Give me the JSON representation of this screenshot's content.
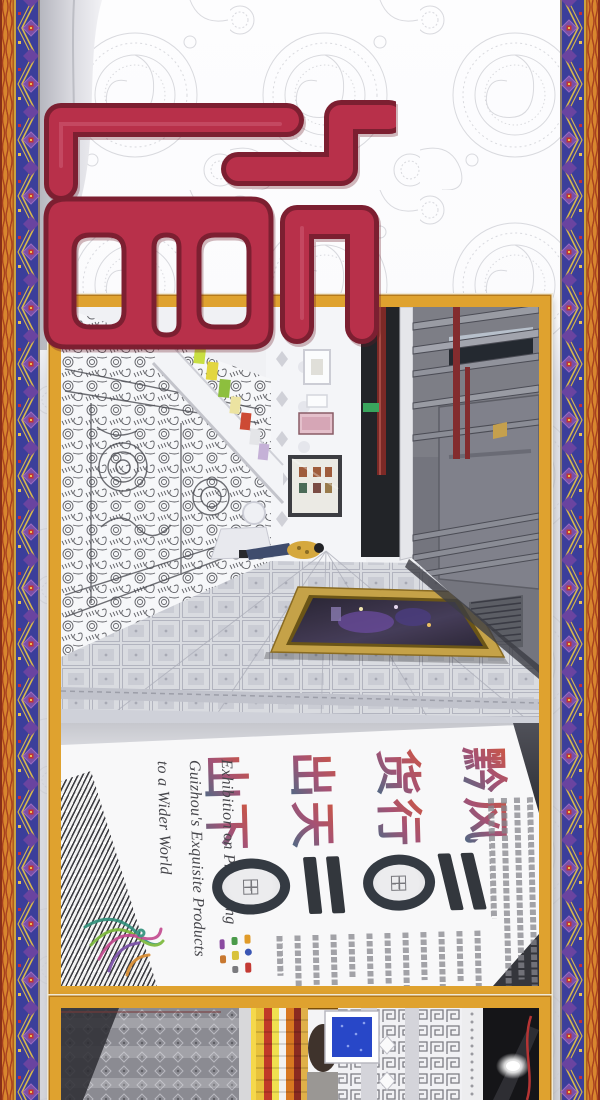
{
  "page": {
    "kind": "exhibition promotional poster page",
    "note": "photos and slogan displayed rotated 90 degrees"
  },
  "poster": {
    "slogan_reading": "黔货出山 风行天下",
    "slogan_columns": [
      {
        "chars": [
          "黔",
          "货",
          "出",
          "山"
        ]
      },
      {
        "chars": [
          "风",
          "行",
          "天",
          "下"
        ]
      }
    ],
    "english_lines": [
      "Exhibition on Promoting",
      "Guizhou's Exquisite Products",
      "to a Wider World"
    ]
  },
  "colors": {
    "frame_gold": "#dfa22f",
    "logo_red": "#b8304a",
    "logo_outline": "#7c1f31",
    "border_blue": "#3b3e9a",
    "border_orange": "#d8862e",
    "border_purple": "#7b4fa5",
    "slogan_gradient_start": "#d8502a",
    "slogan_gradient_end": "#1f6e86",
    "motif_dark": "#343a42"
  }
}
